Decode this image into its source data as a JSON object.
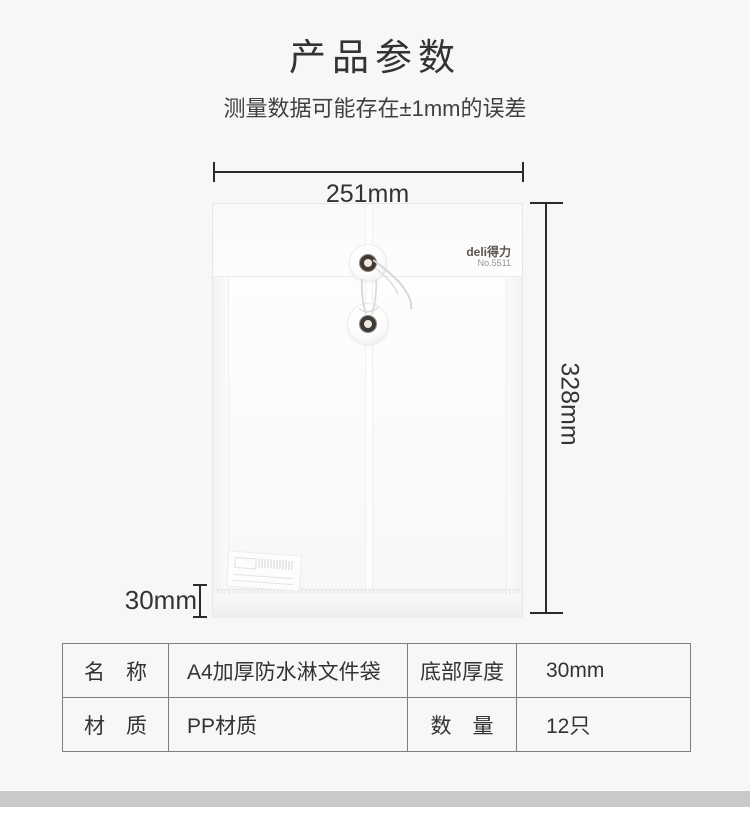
{
  "header": {
    "title": "产品参数",
    "subtitle": "测量数据可能存在±1mm的误差"
  },
  "figure": {
    "width_label": "251mm",
    "height_label": "328mm",
    "thickness_label": "30mm",
    "brand": "deli得力",
    "model_no": "No.5511"
  },
  "spec_table": {
    "rows": [
      [
        "名　称",
        "A4加厚防水淋文件袋",
        "底部厚度",
        "30mm"
      ],
      [
        "材　质",
        "PP材质",
        "数　量",
        "12只"
      ]
    ]
  },
  "colors": {
    "page_bg": "#f7f7f7",
    "text_dark": "#333333",
    "dim_line": "#2b2b2b",
    "table_border": "#7f7f7f",
    "footer_bar": "#c9c9c9"
  }
}
